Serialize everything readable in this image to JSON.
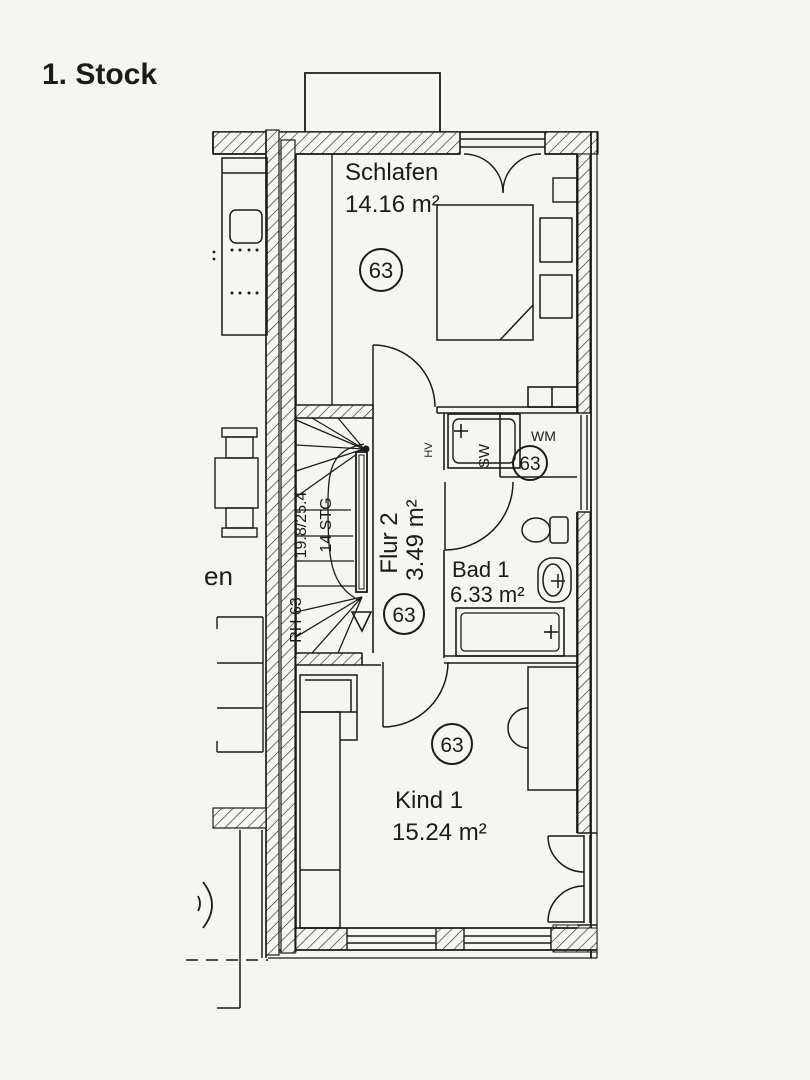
{
  "title": "1. Stock",
  "plan": {
    "unit_number": "63",
    "rooms": [
      {
        "name": "Schlafen",
        "area": "14.16 m²",
        "unit": "63"
      },
      {
        "name": "Flur 2",
        "area": "3.49 m²",
        "unit": "63"
      },
      {
        "name": "Bad 1",
        "area": "6.33 m²",
        "unit": "63"
      },
      {
        "name": "Kind 1",
        "area": "15.24 m²",
        "unit": "63"
      }
    ],
    "stair": {
      "rise_run": "19.8/25.4",
      "steps": "14 STG",
      "house_ref": "RH 63"
    },
    "labels": {
      "washing_machine": "WM",
      "shower": "SW",
      "heating": "HV",
      "neighbor_fragment": "en"
    }
  },
  "colors": {
    "ink": "#1b1b1b",
    "paper": "#f5f5f2"
  }
}
